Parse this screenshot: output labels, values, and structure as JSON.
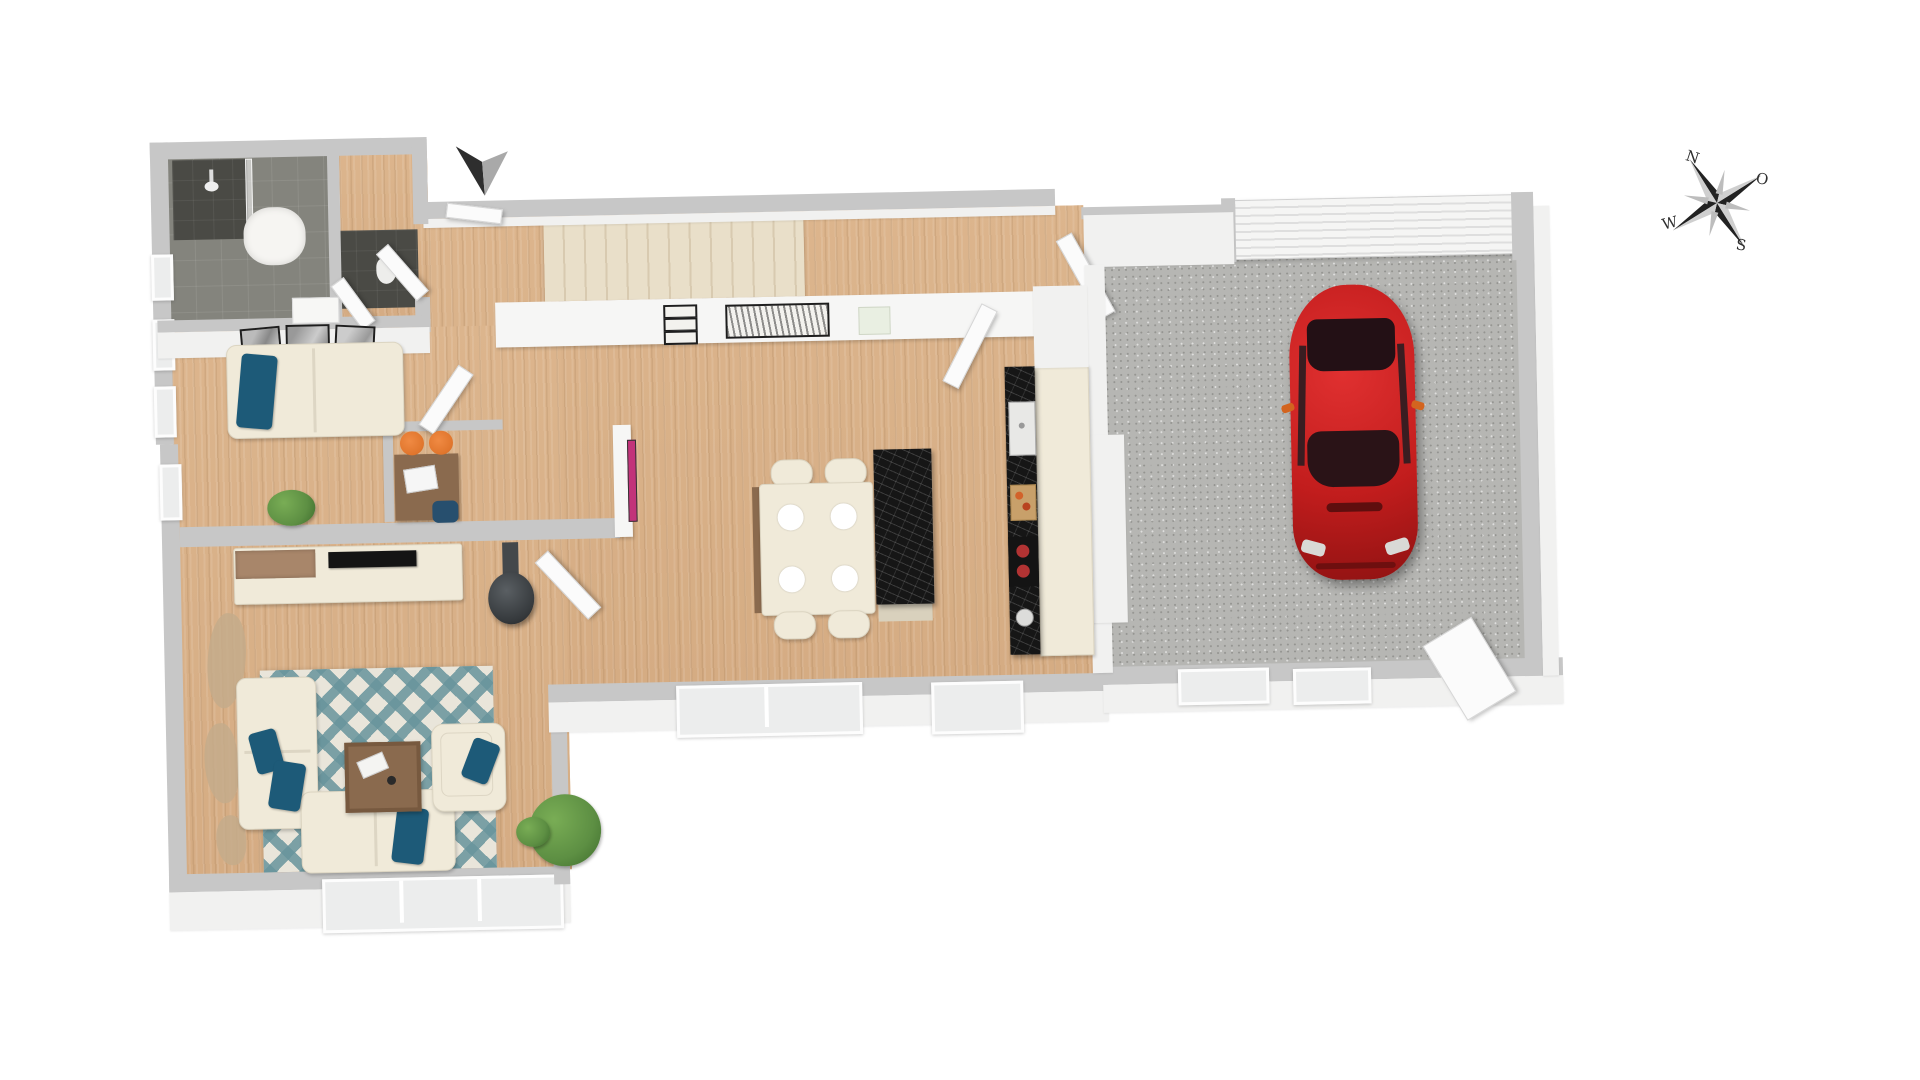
{
  "compass": {
    "north": "N",
    "east": "O",
    "south": "S",
    "west": "W"
  },
  "palette": {
    "wall": "#c7c7c7",
    "wall-face": "#f1f1f0",
    "wood": "#dcb58d",
    "tile-dark": "#84847d",
    "tile-darker": "#4a4a45",
    "concrete": "#b6b6b3",
    "rug-cream": "#e9e5da",
    "rug-teal": "#68949c",
    "sofa-cream": "#f0ead9",
    "pillow-teal": "#1d5a78",
    "chair-orange": "#e0752c",
    "car-red": "#c21d1d",
    "counter-black": "#161616",
    "stair-beige": "#e9dfc9",
    "table-brown": "#8a6a4e",
    "plant-green": "#5d8f43"
  },
  "scene": {
    "view": "3d-top-down-floor-plan",
    "furniture": [
      "shower",
      "shower-tray",
      "vanity",
      "guest-sofa",
      "wall-frames",
      "desk",
      "laptop",
      "orange-stools",
      "tv-lowboard",
      "tv",
      "wood-stove",
      "corner-sofa",
      "armchair",
      "coffee-table",
      "area-rug",
      "floor-plants",
      "dining-table",
      "dining-chairs",
      "plates",
      "kitchen-island",
      "kitchen-counter",
      "sink",
      "cutting-board",
      "cooktop",
      "staircase",
      "stair-wall-art",
      "red-car",
      "garage-door",
      "garage-windows",
      "entrance-arrow"
    ]
  }
}
